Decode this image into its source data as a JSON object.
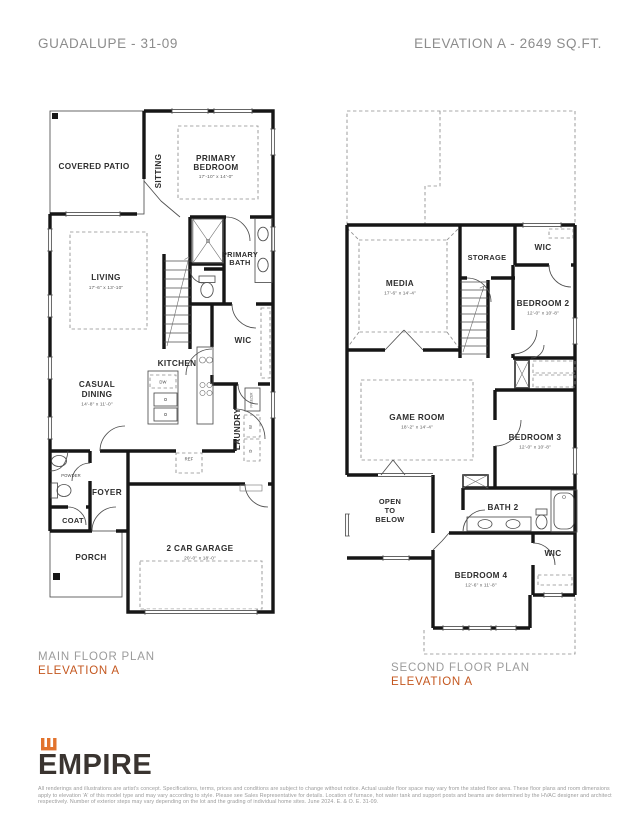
{
  "header": {
    "model": "GUADALUPE - 31-09",
    "elevation_sqft": "ELEVATION A - 2649 SQ.FT."
  },
  "main_floor": {
    "caption": "MAIN FLOOR PLAN",
    "elevation": "ELEVATION A",
    "rooms": {
      "covered_patio": "COVERED PATIO",
      "sitting": "SITTING",
      "primary_bedroom_line1": "PRIMARY",
      "primary_bedroom_line2": "BEDROOM",
      "primary_bedroom_dims": "17'-10\" x 14'-0\"",
      "primary_bath_line1": "PRIMARY",
      "primary_bath_line2": "BATH",
      "living": "LIVING",
      "living_dims": "17'-6\" x 13'-10\"",
      "wic": "WIC",
      "kitchen": "KITCHEN",
      "casual_dining_line1": "CASUAL",
      "casual_dining_line2": "DINING",
      "casual_dining_dims": "14'-8\" x 11'-0\"",
      "laundry": "LAUNDRY",
      "powder": "POWDER",
      "foyer": "FOYER",
      "coat": "COAT",
      "porch": "PORCH",
      "garage": "2 CAR GARAGE",
      "garage_dims": "20'-0\" x 18'-0\"",
      "dw": "DW",
      "ref": "REF",
      "freezer": "FREEZER",
      "washer": "W",
      "dryer": "D"
    }
  },
  "second_floor": {
    "caption": "SECOND FLOOR PLAN",
    "elevation": "ELEVATION A",
    "rooms": {
      "media": "MEDIA",
      "media_dims": "17'-6\" x 14'-4\"",
      "storage": "STORAGE",
      "wic_top": "WIC",
      "bedroom2": "BEDROOM 2",
      "bedroom2_dims": "12'-0\" x 10'-8\"",
      "game_room": "GAME ROOM",
      "game_room_dims": "18'-2\" x 14'-4\"",
      "bedroom3": "BEDROOM 3",
      "bedroom3_dims": "12'-0\" x 10'-8\"",
      "open_below_line1": "OPEN",
      "open_below_line2": "TO",
      "open_below_line3": "BELOW",
      "bath2": "BATH 2",
      "wic_bottom": "WIC",
      "bedroom4": "BEDROOM 4",
      "bedroom4_dims": "12'-6\" x 11'-8\""
    }
  },
  "footer": {
    "brand": "EMPIRE",
    "disclaimer": "All renderings and illustrations are artist's concept. Specifications, terms, prices and conditions are subject to change without notice. Actual usable floor space may vary from the stated floor area. These floor plans and room dimensions apply to elevation 'A' of this model type and may vary according to style. Please see Sales Representative for details. Location of furnace, hot water tank and support posts and beams are determined by the HVAC designer and architect respectively. Number of exterior steps may vary depending on the lot and the grading of individual home sites. June 2024. E. & O. E. 31-09."
  },
  "colors": {
    "accent_orange": "#c4571f",
    "logo_orange": "#e2732d",
    "wall_black": "#161616",
    "header_gray": "#8c8c8c",
    "caption_gray": "#9b9b9b"
  }
}
